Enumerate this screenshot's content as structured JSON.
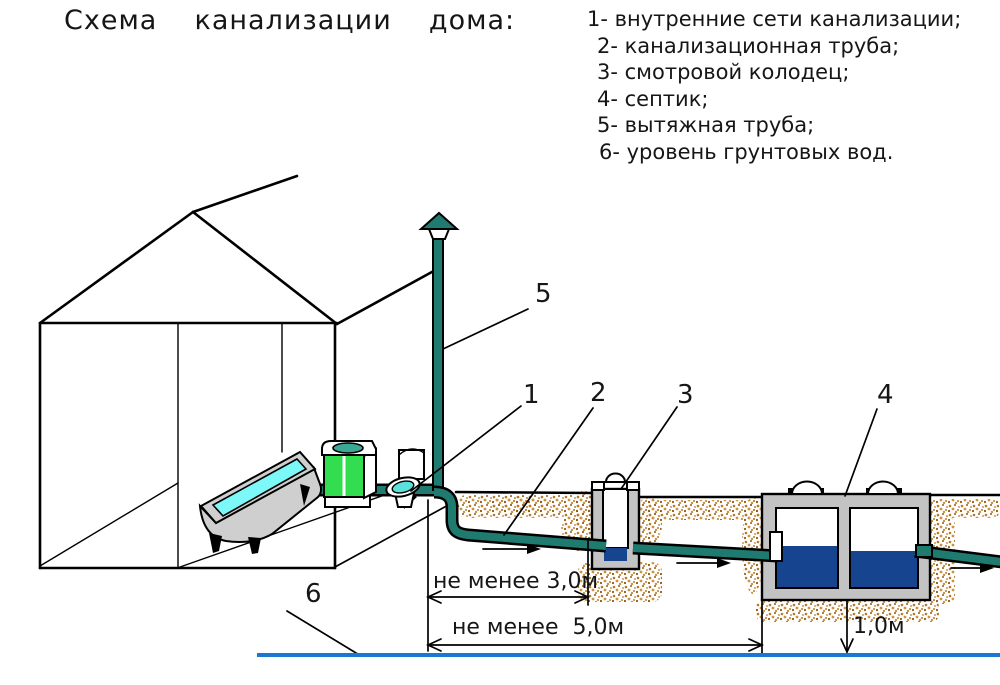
{
  "title": "Схема  канализации  дома:",
  "legend": {
    "items": [
      {
        "text": "1- внутренние сети канализации;"
      },
      {
        "text": "2- канализационная труба;"
      },
      {
        "text": "3- смотровой колодец;"
      },
      {
        "text": "4- септик;"
      },
      {
        "text": "5- вытяжная труба;"
      },
      {
        "text": "6- уровень грунтовых вод."
      }
    ]
  },
  "callouts": {
    "n1": "1",
    "n2": "2",
    "n3": "3",
    "n4": "4",
    "n5": "5",
    "n6": "6"
  },
  "dimensions": {
    "min3": "не менее 3,0м",
    "min5": "не менее  5,0м",
    "depth1": "1,0м"
  },
  "colors": {
    "pipe": "#1f7b6f",
    "sewage": "#16448f",
    "water": "#7df8f8",
    "green": "#32dd4f",
    "sink": "#3aa895",
    "seat": "#5ce0dc",
    "concrete": "#c3c3c3",
    "tub": "#cfcfcf",
    "gwline": "#1c77d2",
    "soil1": "#b57a2a",
    "soil2": "#8f5c16",
    "soil3": "#cc9340"
  }
}
